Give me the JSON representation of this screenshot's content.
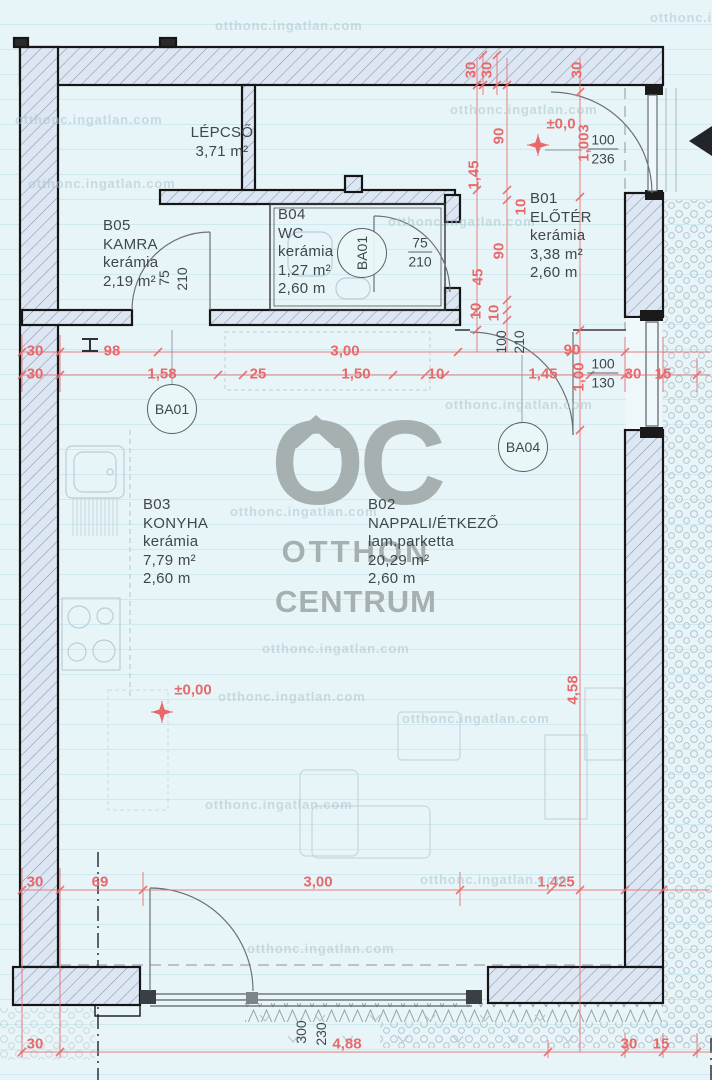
{
  "branding": {
    "logo_text": "OC",
    "line1": "OTTHON",
    "line2": "CENTRUM"
  },
  "watermark": {
    "text": "otthonc.ingatlan.com",
    "positions": [
      {
        "x": 215,
        "y": 18
      },
      {
        "x": 650,
        "y": 10
      },
      {
        "x": 15,
        "y": 112
      },
      {
        "x": 450,
        "y": 102
      },
      {
        "x": 28,
        "y": 176
      },
      {
        "x": 388,
        "y": 214
      },
      {
        "x": 230,
        "y": 504
      },
      {
        "x": 262,
        "y": 641
      },
      {
        "x": 218,
        "y": 689
      },
      {
        "x": 402,
        "y": 711
      },
      {
        "x": 205,
        "y": 797
      },
      {
        "x": 420,
        "y": 872
      },
      {
        "x": 247,
        "y": 941
      },
      {
        "x": 445,
        "y": 397
      }
    ]
  },
  "rooms": [
    {
      "lines": [
        "LÉPCSŐ",
        "3,71 m²"
      ],
      "x": 222,
      "y": 124,
      "align": "center"
    },
    {
      "lines": [
        "B05",
        "KAMRA",
        "kerámia",
        "2,19 m²"
      ],
      "x": 103,
      "y": 217,
      "align": "left"
    },
    {
      "lines": [
        "B04",
        "WC",
        "kerámia",
        "1,27 m²",
        "2,60 m"
      ],
      "x": 278,
      "y": 206,
      "align": "left"
    },
    {
      "lines": [
        "B01",
        "ELŐTÉR",
        "kerámia",
        "3,38 m²",
        "2,60 m"
      ],
      "x": 530,
      "y": 190,
      "align": "left"
    },
    {
      "lines": [
        "B03",
        "KONYHA",
        "kerámia",
        "7,79 m²",
        "2,60 m"
      ],
      "x": 143,
      "y": 496,
      "align": "left"
    },
    {
      "lines": [
        "B02",
        "NAPPALI/ÉTKEZŐ",
        "lam.parketta",
        "20,29 m²",
        "2,60 m"
      ],
      "x": 368,
      "y": 496,
      "align": "left"
    }
  ],
  "tags": [
    {
      "t": "BA01",
      "x": 362,
      "y": 253,
      "r": -90
    },
    {
      "t": "BA01",
      "x": 172,
      "y": 409,
      "r": 0
    },
    {
      "t": "BA04",
      "x": 523,
      "y": 447,
      "r": 0
    }
  ],
  "fractions": [
    {
      "top": "75",
      "bottom": "210",
      "x": 420,
      "y": 252
    },
    {
      "top": "100",
      "bottom": "236",
      "x": 603,
      "y": 149
    },
    {
      "top": "100",
      "bottom": "130",
      "x": 603,
      "y": 373
    }
  ],
  "levels": [
    {
      "t": "±0,0",
      "x": 561,
      "y": 124
    },
    {
      "t": "±0,00",
      "x": 193,
      "y": 690
    }
  ],
  "dim_labels": {
    "red": [
      {
        "t": "30",
        "x": 471,
        "y": 70,
        "r": -90
      },
      {
        "t": "30",
        "x": 487,
        "y": 70,
        "r": -90
      },
      {
        "t": "30",
        "x": 577,
        "y": 70,
        "r": -90
      },
      {
        "t": "1,45",
        "x": 474,
        "y": 175,
        "r": -90
      },
      {
        "t": "45",
        "x": 478,
        "y": 277,
        "r": -90
      },
      {
        "t": "10",
        "x": 476,
        "y": 311,
        "r": -90
      },
      {
        "t": "90",
        "x": 499,
        "y": 136,
        "r": -90
      },
      {
        "t": "10",
        "x": 521,
        "y": 207,
        "r": -90
      },
      {
        "t": "90",
        "x": 499,
        "y": 251,
        "r": -90
      },
      {
        "t": "10",
        "x": 494,
        "y": 313,
        "r": -90
      },
      {
        "t": "1,003",
        "x": 584,
        "y": 143,
        "r": -90
      },
      {
        "t": "30",
        "x": 35,
        "y": 351,
        "r": 0
      },
      {
        "t": "98",
        "x": 112,
        "y": 351,
        "r": 0
      },
      {
        "t": "3,00",
        "x": 345,
        "y": 351,
        "r": 0
      },
      {
        "t": "90",
        "x": 572,
        "y": 350,
        "r": 0
      },
      {
        "t": "30",
        "x": 35,
        "y": 374,
        "r": 0
      },
      {
        "t": "1,58",
        "x": 162,
        "y": 374,
        "r": 0
      },
      {
        "t": "25",
        "x": 258,
        "y": 374,
        "r": 0
      },
      {
        "t": "1,50",
        "x": 356,
        "y": 374,
        "r": 0
      },
      {
        "t": "10",
        "x": 436,
        "y": 374,
        "r": 0
      },
      {
        "t": "1,45",
        "x": 543,
        "y": 374,
        "r": 0
      },
      {
        "t": "30",
        "x": 633,
        "y": 374,
        "r": 0
      },
      {
        "t": "15",
        "x": 663,
        "y": 374,
        "r": 0
      },
      {
        "t": "1,00",
        "x": 579,
        "y": 377,
        "r": -90
      },
      {
        "t": "4,58",
        "x": 573,
        "y": 690,
        "r": -90
      },
      {
        "t": "30",
        "x": 35,
        "y": 882,
        "r": 0
      },
      {
        "t": "69",
        "x": 100,
        "y": 882,
        "r": 0
      },
      {
        "t": "3,00",
        "x": 318,
        "y": 882,
        "r": 0
      },
      {
        "t": "1,425",
        "x": 556,
        "y": 882,
        "r": 0
      },
      {
        "t": "30",
        "x": 35,
        "y": 1044,
        "r": 0
      },
      {
        "t": "4,88",
        "x": 347,
        "y": 1044,
        "r": 0
      },
      {
        "t": "30",
        "x": 629,
        "y": 1044,
        "r": 0
      },
      {
        "t": "15",
        "x": 661,
        "y": 1044,
        "r": 0
      }
    ],
    "black": [
      {
        "t": "75",
        "x": 164,
        "y": 278,
        "r": -90
      },
      {
        "t": "210",
        "x": 182,
        "y": 279,
        "r": -90
      },
      {
        "t": "100",
        "x": 501,
        "y": 342,
        "r": -90
      },
      {
        "t": "210",
        "x": 519,
        "y": 342,
        "r": -90
      },
      {
        "t": "300",
        "x": 301,
        "y": 1032,
        "r": -90
      },
      {
        "t": "230",
        "x": 321,
        "y": 1034,
        "r": -90
      }
    ]
  }
}
